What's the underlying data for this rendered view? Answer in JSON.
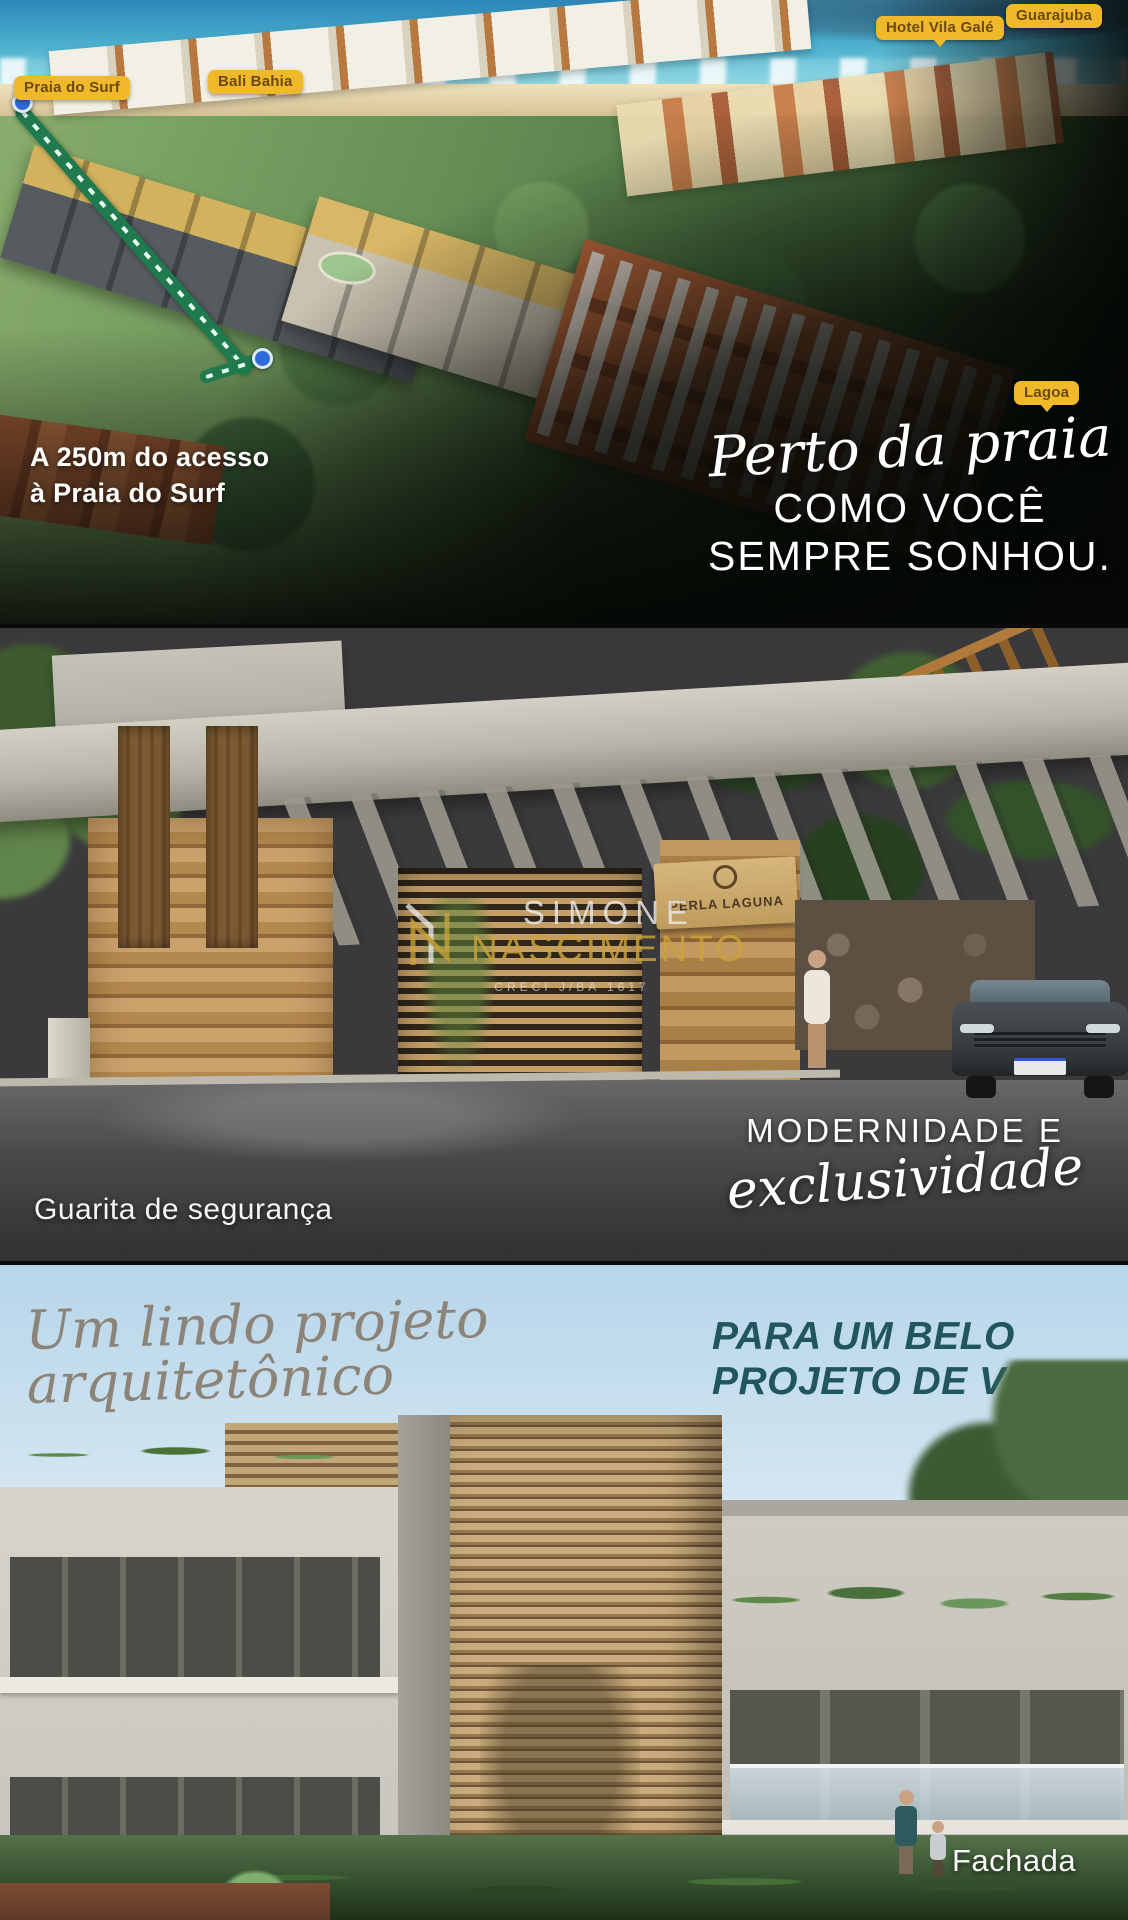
{
  "aerial": {
    "tags": [
      {
        "label": "Praia do Surf"
      },
      {
        "label": "Bali Bahia"
      },
      {
        "label": "Hotel Vila Galé"
      },
      {
        "label": "Guarajuba"
      },
      {
        "label": "Lagoa"
      }
    ],
    "distance_line1": "A 250m do acesso",
    "distance_line2": "à Praia do Surf",
    "headline_script": "Perto da praia",
    "headline_line1": "COMO VOCÊ",
    "headline_line2": "SEMPRE SONHOU."
  },
  "gatehouse": {
    "sign_text": "PERLA LAGUNA",
    "caption": "Guarita de segurança",
    "headline_caps": "MODERNIDADE E",
    "headline_script": "exclusividade",
    "watermark": {
      "line1": "SIMONE",
      "line2": "NASCIMENTO",
      "creci": "CRECI J/BA 1617"
    }
  },
  "facade": {
    "headline_script": "Um lindo projeto arquitetônico",
    "headline_line1": "PARA UM BELO",
    "headline_line2": "PROJETO DE VIDA.",
    "caption": "Fachada"
  },
  "colors": {
    "tag_yellow": "#f0b92c",
    "tag_text_brown": "#6b4a10",
    "route_green": "#1f7a4d",
    "pin_blue": "#2d6bd8",
    "teal_heading": "#20565c",
    "script_taupe": "#8c8478",
    "watermark_gold": "#cba23a",
    "white_text": "#ffffff"
  }
}
